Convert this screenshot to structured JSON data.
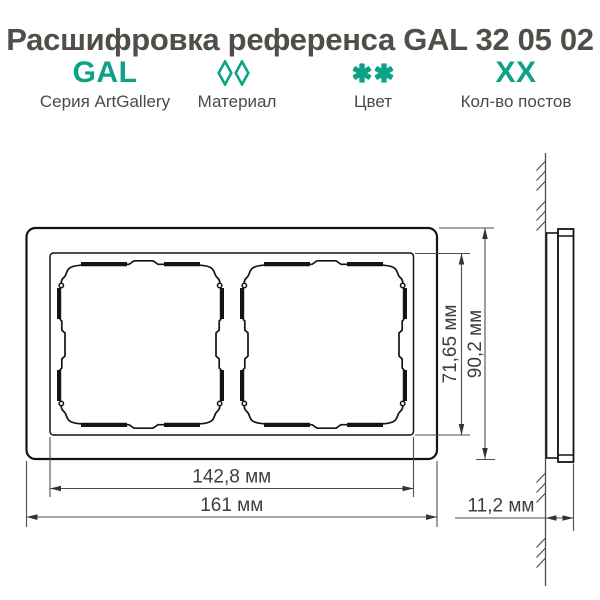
{
  "title": "Расшифровка референса GAL 32 05 02",
  "legend": {
    "accent_color": "#0ba288",
    "items": [
      {
        "code": "GAL",
        "label": "Серия ArtGallery"
      },
      {
        "icon": "two-diamonds",
        "label": "Материал"
      },
      {
        "icon": "two-asterisks",
        "label": "Цвет"
      },
      {
        "code": "XX",
        "label": "Кол-во постов"
      }
    ]
  },
  "drawing": {
    "line_color": "#141414",
    "dim_color": "#4f4f4f",
    "views": [
      "front-view-double-frame",
      "side-profile-on-wall"
    ],
    "dimensions": {
      "inner_height": "71,65 мм",
      "outer_height": "90,2 мм",
      "inner_width": "142,8 мм",
      "outer_width": "161 мм",
      "depth": "11,2 мм"
    }
  }
}
